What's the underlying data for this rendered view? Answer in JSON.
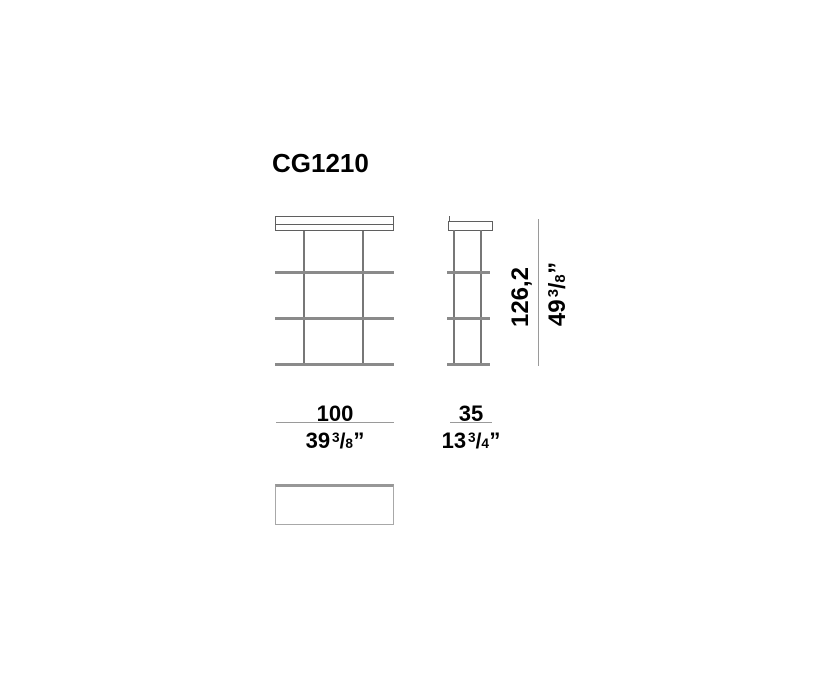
{
  "product": {
    "code": "CG1210"
  },
  "dimensions": {
    "height": {
      "metric": "126,2",
      "imperial_whole": "49",
      "imperial_frac_num": "3",
      "imperial_frac_sep": "/",
      "imperial_frac_den": "8",
      "imperial_unit": "”"
    },
    "width": {
      "metric": "100",
      "imperial_whole": "39",
      "imperial_frac_num": "3",
      "imperial_frac_sep": "/",
      "imperial_frac_den": "8",
      "imperial_unit": "”"
    },
    "depth": {
      "metric": "35",
      "imperial_whole": "13",
      "imperial_frac_num": "3",
      "imperial_frac_sep": "/",
      "imperial_frac_den": "4",
      "imperial_unit": "”"
    }
  },
  "colors": {
    "text": "#000000",
    "outline_gray": "#5f5f5f",
    "post_gray": "#777777",
    "shelf_gray": "#8a8a8a",
    "dimension_line_gray": "#9a9a9a",
    "background": "#ffffff"
  }
}
